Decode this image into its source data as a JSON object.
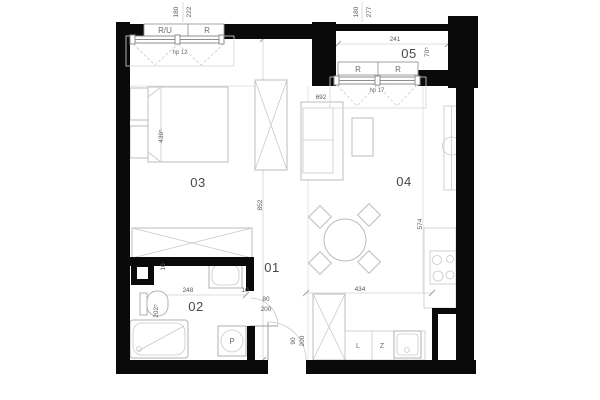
{
  "plan": {
    "rooms": {
      "hall": "01",
      "bath": "02",
      "bedroom": "03",
      "living": "04",
      "loggia": "05"
    },
    "windows": {
      "w1": {
        "label_left": "R/U",
        "label_right": "R",
        "dim1": "180",
        "dim2": "222",
        "hp": "hp 12"
      },
      "w2": {
        "label_left": "R",
        "label_right": "R",
        "dim1": "180",
        "dim2": "277",
        "hp": "hp 17"
      }
    },
    "dims": {
      "hall_height": "852",
      "living_height": "574",
      "kitchen_width": "434",
      "bath_width": "248",
      "bath_height": "202⁵",
      "wall_left": "10",
      "wall_right": "10",
      "bed": "439⁵",
      "sofa": "692",
      "loggia_width": "241",
      "loggia_depth": "70⁵"
    },
    "doors": {
      "bath": {
        "w": "80",
        "h": "200"
      },
      "entry": {
        "w": "90",
        "h": "200"
      }
    },
    "kitchen": {
      "cab_l": "L",
      "cab_z": "Z"
    },
    "appliances": {
      "washer": "P"
    },
    "colors": {
      "wall": "#0a0a0a",
      "line": "#bcbcbc",
      "text": "#5a5a5a"
    }
  }
}
